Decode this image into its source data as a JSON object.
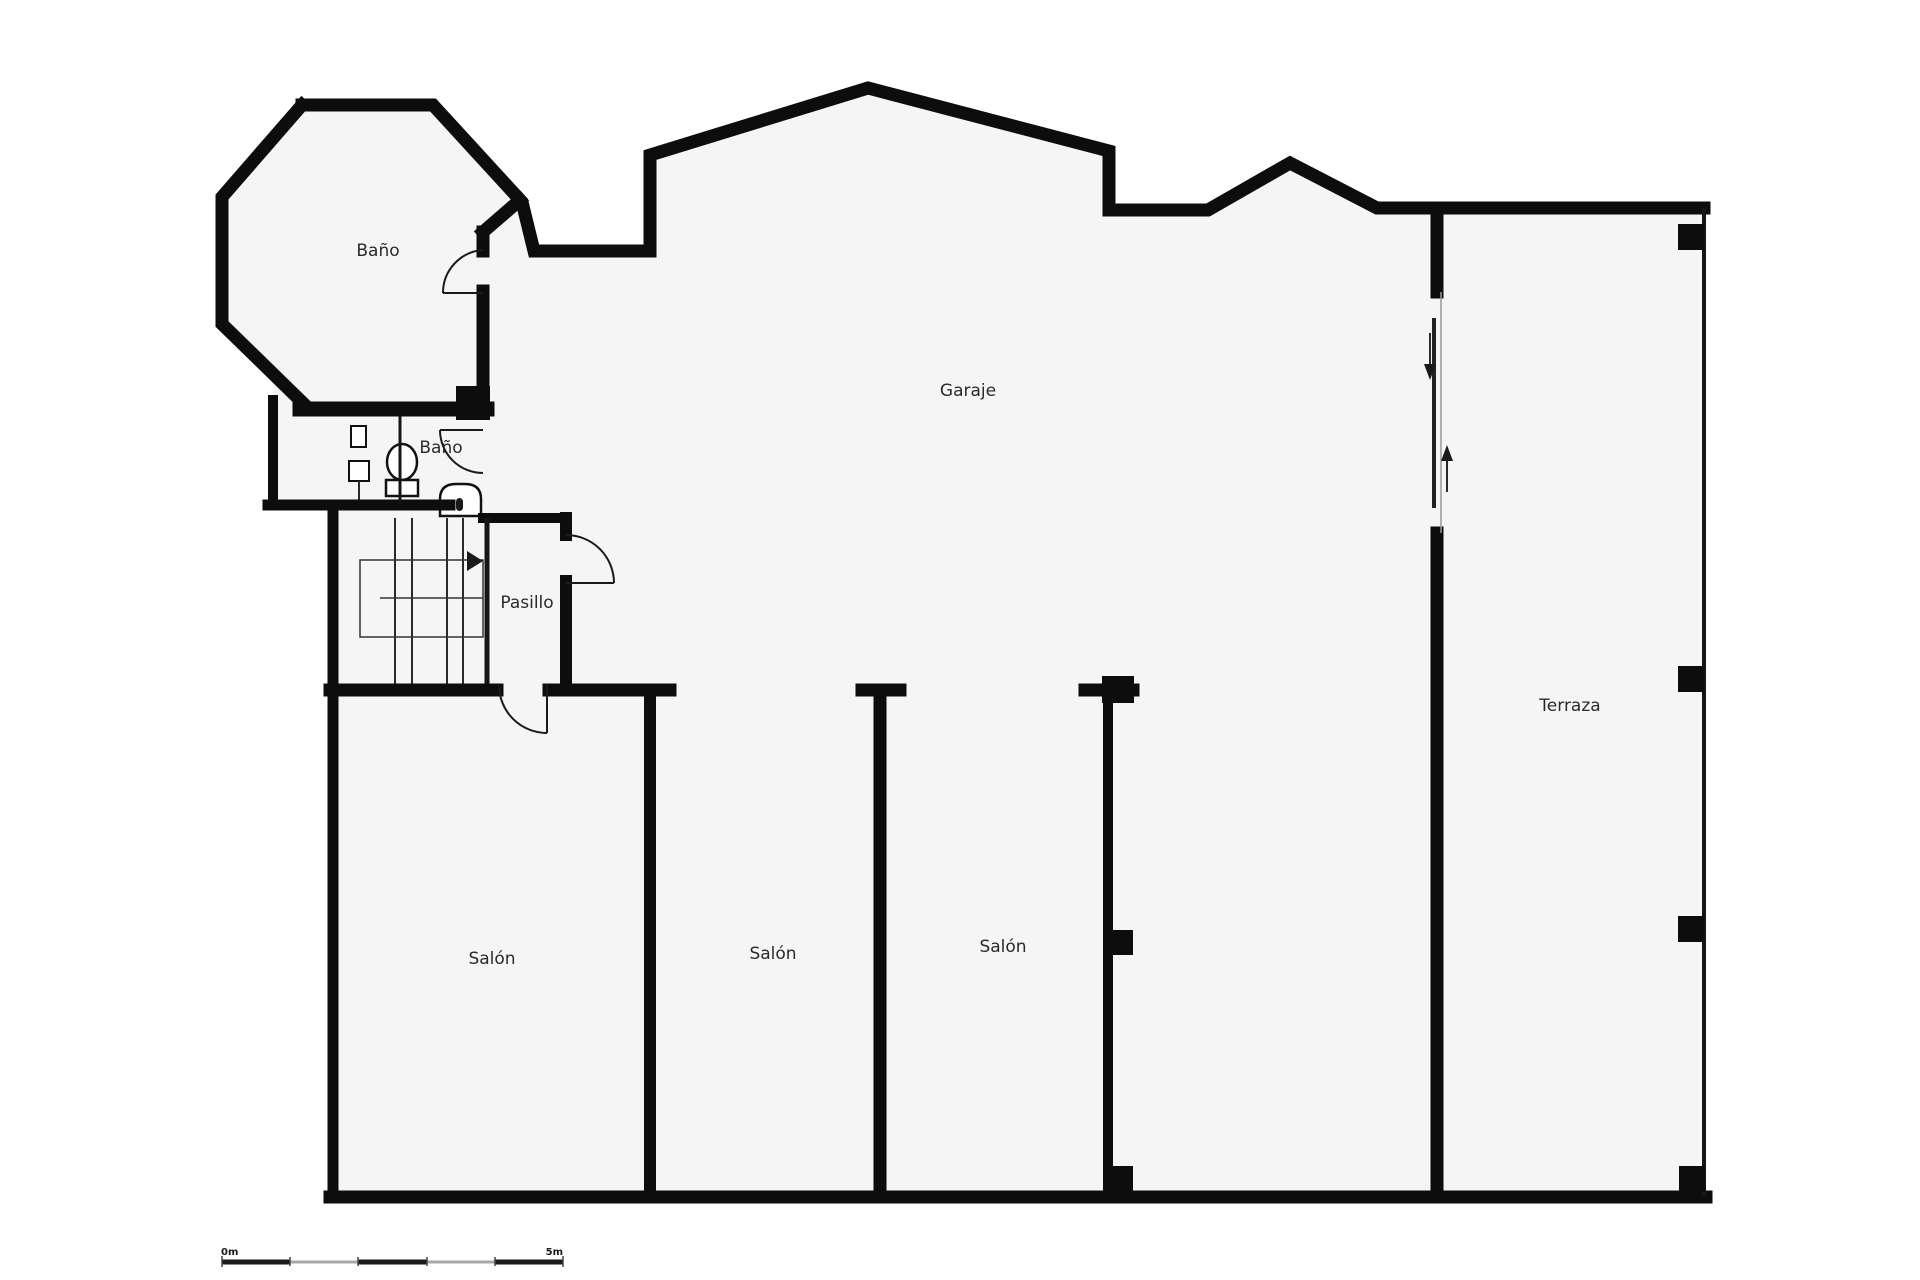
{
  "plan": {
    "title": "floor-plan",
    "rooms": [
      {
        "id": "bano-octagon",
        "label": "Baño"
      },
      {
        "id": "bano-small",
        "label": "Baño"
      },
      {
        "id": "garaje",
        "label": "Garaje"
      },
      {
        "id": "pasillo",
        "label": "Pasillo"
      },
      {
        "id": "salon-left",
        "label": "Salón"
      },
      {
        "id": "salon-middle",
        "label": "Salón"
      },
      {
        "id": "salon-right",
        "label": "Salón"
      },
      {
        "id": "terraza",
        "label": "Terraza"
      }
    ],
    "scale_bar": {
      "start_label": "0m",
      "end_label": "5m"
    },
    "colors": {
      "wall": "#0d0d0d",
      "floor": "#f5f5f5",
      "background": "#ffffff",
      "door_line": "#1a1a1a",
      "scale_gray": "#a8a8a8",
      "label_text": "#2a2a2a"
    }
  }
}
